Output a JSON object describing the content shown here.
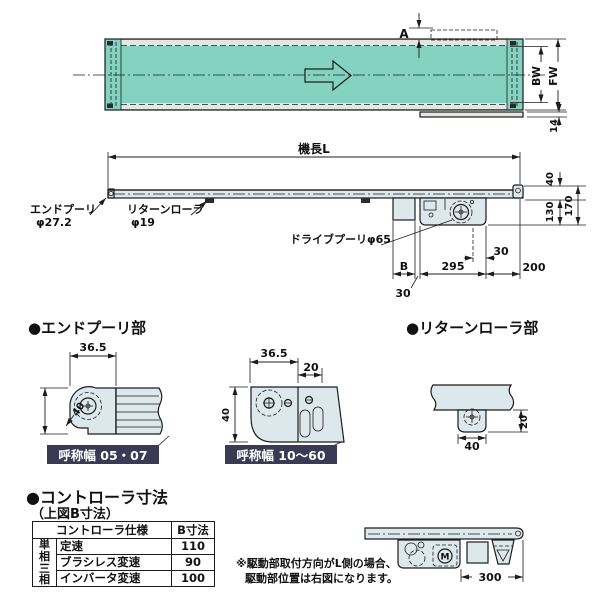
{
  "colors": {
    "belt_fill": "#84d2c1",
    "part_fill": "#dde8ec",
    "plate_bg": "#3a3a54",
    "plate_fg": "#ffffff",
    "line": "#1c1c1c"
  },
  "top_view": {
    "dim_a": "A",
    "dim_bw": "BW",
    "dim_fw": "FW",
    "dim_14": "14"
  },
  "side_view": {
    "length_label": "機長L",
    "dim_40": "40",
    "dim_130": "130",
    "dim_170": "170",
    "end_pulley_name": "エンドプーリ",
    "end_pulley_dia": "φ27.2",
    "return_roller_name": "リターンローラ",
    "return_roller_dia": "φ19",
    "drive_pulley_label": "ドライブプーリφ65",
    "dim_b": "B",
    "dim_30_gap": "30",
    "dim_295": "295",
    "dim_30_offset": "30",
    "dim_200": "200"
  },
  "end_pulley_section": {
    "heading": "●エンドプーリ部",
    "narrow": {
      "dim_width": "36.5",
      "dim_height": "40",
      "plate": "呼称幅 05・07"
    },
    "wide": {
      "dim_width": "36.5",
      "dim_20": "20",
      "dim_height": "40",
      "plate": "呼称幅 10～60"
    }
  },
  "return_roller_section": {
    "heading": "●リターンローラ部",
    "dim_40": "40",
    "dim_20": "20"
  },
  "controller": {
    "heading": "●コントローラ寸法",
    "subheading": "（上図B寸法）",
    "col_spec": "コントローラ仕様",
    "col_b": "B寸法",
    "phase1": "単相",
    "phase2": "三相",
    "rows": [
      {
        "spec": "定速",
        "b": "110"
      },
      {
        "spec": "ブラシレス変速",
        "b": "90"
      },
      {
        "spec": "インバータ変速",
        "b": "100"
      }
    ]
  },
  "note": {
    "line1": "※駆動部取付方向がL側の場合、",
    "line2": "駆動部位置は右図になります。",
    "dim_300": "300",
    "motor_label": "M"
  }
}
